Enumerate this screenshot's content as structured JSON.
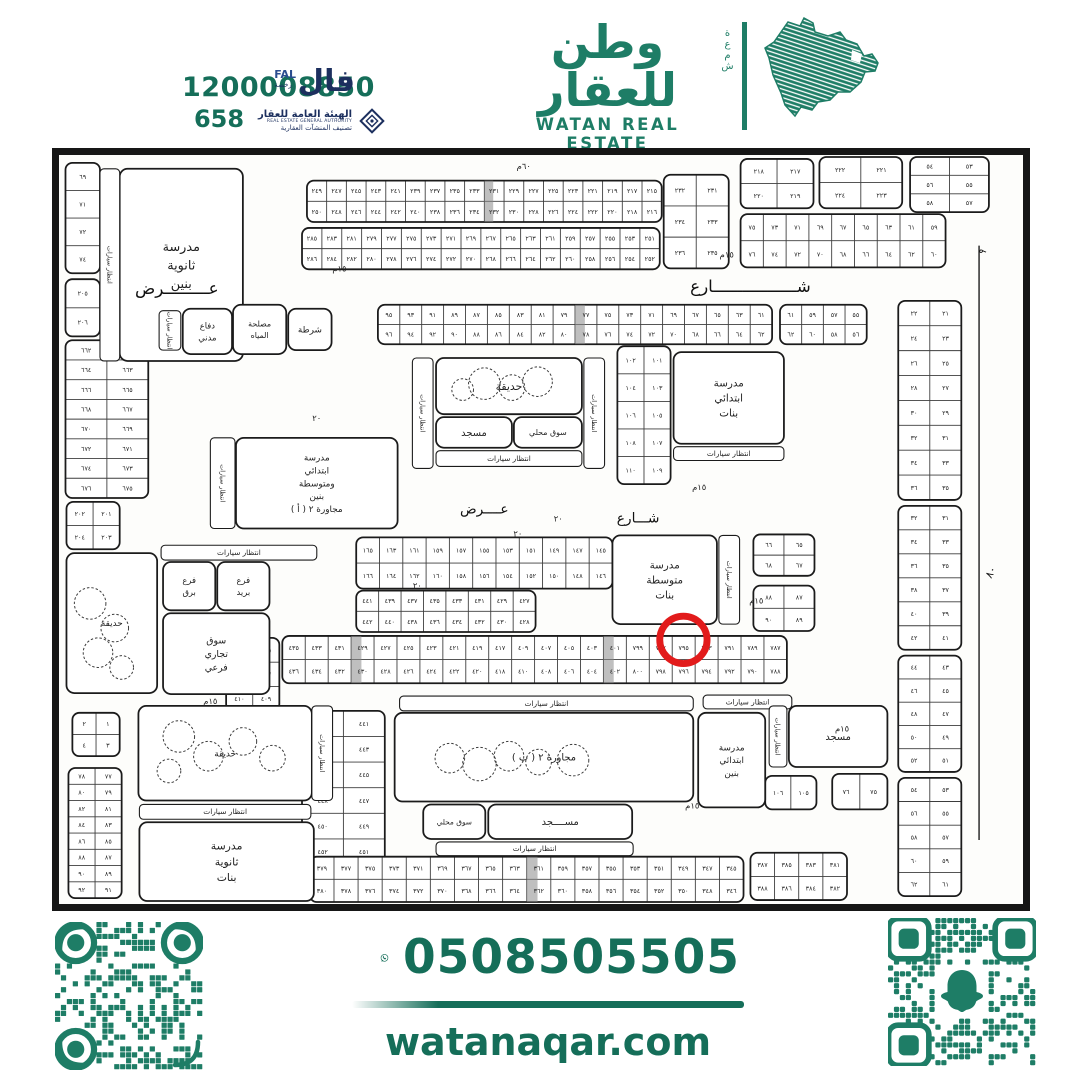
{
  "colors": {
    "brand": "#1E7D66",
    "deep": "#156E59",
    "navy": "#1C2F5E",
    "ink": "#1b1b1b",
    "red": "#E21B1B"
  },
  "header": {
    "phone1": "1200008850",
    "phone2": "658",
    "fal": {
      "ar": "فال",
      "latin": "FAL",
      "license": "رخصة"
    },
    "rega": {
      "l1": "الهيئة العامة للعقار",
      "l2": "REAL ESTATE GENERAL AUTHORITY",
      "l3": "تصنيف المنشآت العقارية"
    }
  },
  "brand": {
    "ar": "وطن للعقار",
    "en": "WATAN REAL ESTATE",
    "vertical": "شمعة"
  },
  "footer": {
    "phone": "0508505505",
    "site": "watanaqar.com"
  },
  "map": {
    "parking": "انتظار سيارات",
    "streets": [
      {
        "t": "عـــــــــرض",
        "x": 118,
        "y": 141,
        "fs": 17
      },
      {
        "t": "شـــــــــــــــــارع",
        "x": 700,
        "y": 139,
        "fs": 17
      },
      {
        "t": "عــــرض",
        "x": 430,
        "y": 364,
        "fs": 14
      },
      {
        "t": "شـــارع",
        "x": 586,
        "y": 373,
        "fs": 14
      },
      {
        "t": "٨٠",
        "x": 947,
        "y": 425,
        "fs": 11,
        "rot": -62
      },
      {
        "t": "٩",
        "x": 938,
        "y": 100,
        "fs": 10,
        "rot": -55
      }
    ],
    "wlabels": [
      {
        "t": "١٥م",
        "x": 283,
        "y": 118
      },
      {
        "t": "١٥م",
        "x": 676,
        "y": 104
      },
      {
        "t": "١٥م",
        "x": 648,
        "y": 340
      },
      {
        "t": "١٥م",
        "x": 706,
        "y": 455
      },
      {
        "t": "١٥م",
        "x": 641,
        "y": 663
      },
      {
        "t": "١٥م",
        "x": 152,
        "y": 557
      },
      {
        "t": "٢٠",
        "x": 260,
        "y": 270
      },
      {
        "t": "٢٠",
        "x": 362,
        "y": 440
      },
      {
        "t": "٢٠",
        "x": 464,
        "y": 387
      },
      {
        "t": "٢٠",
        "x": 505,
        "y": 372
      },
      {
        "t": "٦٠م",
        "x": 470,
        "y": 14
      },
      {
        "t": "١٥م",
        "x": 793,
        "y": 585
      }
    ],
    "landmarks": [
      {
        "id": "sec-boys-school",
        "x": 60,
        "y": 14,
        "w": 125,
        "h": 195,
        "fs": 13,
        "l": [
          "مدرسة",
          "ثانوية",
          "بنين"
        ]
      },
      {
        "id": "civil-defense",
        "x": 124,
        "y": 156,
        "w": 50,
        "h": 46,
        "fs": 8.5,
        "l": [
          "دفاع",
          "مدني"
        ]
      },
      {
        "id": "water-authority",
        "x": 175,
        "y": 152,
        "w": 54,
        "h": 50,
        "fs": 8,
        "l": [
          "مصلحة",
          "المياه"
        ]
      },
      {
        "id": "police",
        "x": 231,
        "y": 156,
        "w": 44,
        "h": 42,
        "fs": 9,
        "l": [
          "شرطة"
        ]
      },
      {
        "id": "garden-top",
        "x": 381,
        "y": 206,
        "w": 148,
        "h": 57,
        "fs": 11,
        "l": [
          "حديقة"
        ]
      },
      {
        "id": "mosque-top",
        "x": 381,
        "y": 266,
        "w": 77,
        "h": 31,
        "fs": 10,
        "l": [
          "مسجد"
        ]
      },
      {
        "id": "market-top",
        "x": 460,
        "y": 266,
        "w": 69,
        "h": 31,
        "fs": 8,
        "l": [
          "سوق محلي"
        ]
      },
      {
        "id": "girls-primary-school",
        "x": 622,
        "y": 200,
        "w": 112,
        "h": 93,
        "fs": 10.5,
        "l": [
          "مدرسة",
          "ابتدائي",
          "بنات"
        ]
      },
      {
        "id": "school-2a",
        "x": 178,
        "y": 287,
        "w": 164,
        "h": 92,
        "fs": 9,
        "l": [
          "مدرسة",
          "ابتدائي",
          "ومتوسطة",
          "بنين",
          "مجاورة ٢ ( أ )"
        ]
      },
      {
        "id": "telegraph-branch",
        "x": 104,
        "y": 413,
        "w": 53,
        "h": 49,
        "fs": 8.5,
        "l": [
          "فرع",
          "برق"
        ]
      },
      {
        "id": "post-branch",
        "x": 159,
        "y": 413,
        "w": 53,
        "h": 49,
        "fs": 8.5,
        "l": [
          "فرع",
          "بريد"
        ]
      },
      {
        "id": "sub-market",
        "x": 104,
        "y": 465,
        "w": 108,
        "h": 82,
        "fs": 9.5,
        "l": [
          "سوق",
          "تجاري",
          "فرعي"
        ]
      },
      {
        "id": "garden-left",
        "x": 6,
        "y": 404,
        "w": 92,
        "h": 142,
        "fs": 9,
        "l": [
          "حديقة"
        ]
      },
      {
        "id": "girls-middle-school",
        "x": 560,
        "y": 386,
        "w": 106,
        "h": 90,
        "fs": 10.5,
        "l": [
          "مدرسة",
          "متوسطة",
          "بنات"
        ]
      },
      {
        "id": "block-2b",
        "x": 339,
        "y": 566,
        "w": 303,
        "h": 90,
        "fs": 10,
        "l": [
          "مجاورة ٢ ( ب )"
        ]
      },
      {
        "id": "market-2b",
        "x": 368,
        "y": 659,
        "w": 63,
        "h": 35,
        "fs": 7.5,
        "l": [
          "سوق محلي"
        ]
      },
      {
        "id": "mosque-2b",
        "x": 434,
        "y": 659,
        "w": 146,
        "h": 35,
        "fs": 10,
        "l": [
          "مســــجد"
        ]
      },
      {
        "id": "boys-primary-school",
        "x": 647,
        "y": 566,
        "w": 68,
        "h": 96,
        "fs": 9,
        "l": [
          "مدرسة",
          "ابتدائي",
          "بنين"
        ]
      },
      {
        "id": "mosque-east",
        "x": 739,
        "y": 559,
        "w": 100,
        "h": 62,
        "fs": 10,
        "l": [
          "مسجد"
        ]
      },
      {
        "id": "garden-bottom",
        "x": 79,
        "y": 559,
        "w": 176,
        "h": 96,
        "fs": 9,
        "l": [
          "حديقة"
        ]
      },
      {
        "id": "girls-sec-school",
        "x": 80,
        "y": 677,
        "w": 177,
        "h": 80,
        "fs": 11,
        "l": [
          "مدرسة",
          "ثانوية",
          "بنات"
        ]
      }
    ],
    "plabels": [
      {
        "x": 40,
        "y": 14,
        "w": 20,
        "h": 195,
        "v": 1
      },
      {
        "x": 100,
        "y": 158,
        "w": 22,
        "h": 40,
        "v": 1
      },
      {
        "x": 357,
        "y": 206,
        "w": 21,
        "h": 112,
        "v": 1
      },
      {
        "x": 531,
        "y": 206,
        "w": 21,
        "h": 112,
        "v": 1
      },
      {
        "x": 381,
        "y": 300,
        "w": 148,
        "h": 16
      },
      {
        "x": 622,
        "y": 296,
        "w": 112,
        "h": 14
      },
      {
        "x": 152,
        "y": 287,
        "w": 25,
        "h": 92,
        "v": 1
      },
      {
        "x": 102,
        "y": 396,
        "w": 158,
        "h": 15
      },
      {
        "x": 668,
        "y": 386,
        "w": 21,
        "h": 90,
        "v": 1
      },
      {
        "x": 344,
        "y": 549,
        "w": 298,
        "h": 15
      },
      {
        "x": 381,
        "y": 697,
        "w": 200,
        "h": 14
      },
      {
        "x": 652,
        "y": 548,
        "w": 90,
        "h": 14
      },
      {
        "x": 719,
        "y": 559,
        "w": 18,
        "h": 62,
        "v": 1
      },
      {
        "x": 255,
        "y": 559,
        "w": 21,
        "h": 96,
        "v": 1
      },
      {
        "x": 80,
        "y": 659,
        "w": 174,
        "h": 15
      }
    ],
    "trees": [
      {
        "x": 430,
        "y": 232,
        "r": 16
      },
      {
        "x": 458,
        "y": 236,
        "r": 13
      },
      {
        "x": 484,
        "y": 230,
        "r": 15
      },
      {
        "x": 408,
        "y": 238,
        "r": 11
      },
      {
        "x": 30,
        "y": 455,
        "r": 16
      },
      {
        "x": 55,
        "y": 480,
        "r": 14
      },
      {
        "x": 38,
        "y": 505,
        "r": 15
      },
      {
        "x": 62,
        "y": 520,
        "r": 12
      },
      {
        "x": 395,
        "y": 612,
        "r": 15
      },
      {
        "x": 425,
        "y": 618,
        "r": 17
      },
      {
        "x": 455,
        "y": 610,
        "r": 15
      },
      {
        "x": 485,
        "y": 616,
        "r": 13
      },
      {
        "x": 520,
        "y": 614,
        "r": 16
      },
      {
        "x": 120,
        "y": 590,
        "r": 16
      },
      {
        "x": 150,
        "y": 610,
        "r": 15
      },
      {
        "x": 185,
        "y": 595,
        "r": 14
      },
      {
        "x": 215,
        "y": 612,
        "r": 13
      },
      {
        "x": 110,
        "y": 625,
        "r": 12
      }
    ],
    "blocks": [
      {
        "x": 5,
        "y": 8,
        "w": 35,
        "h": 112,
        "c": 1,
        "r": 4,
        "n": [
          "٦٩",
          "٧١",
          "٧٢",
          "٧٤"
        ]
      },
      {
        "x": 5,
        "y": 126,
        "w": 35,
        "h": 58,
        "c": 1,
        "r": 2,
        "n": [
          "٢٠٥",
          "٢٠٦"
        ]
      },
      {
        "x": 250,
        "y": 26,
        "w": 360,
        "h": 42,
        "c": 18,
        "r": 2,
        "g": "h249",
        "ht": [
          9
        ]
      },
      {
        "x": 245,
        "y": 74,
        "w": 363,
        "h": 42,
        "c": 18,
        "r": 2,
        "g": "h285"
      },
      {
        "x": 612,
        "y": 20,
        "w": 66,
        "h": 95,
        "c": 2,
        "r": 3,
        "g": "v231"
      },
      {
        "x": 690,
        "y": 4,
        "w": 74,
        "h": 50,
        "c": 2,
        "r": 2,
        "g": "v217"
      },
      {
        "x": 770,
        "y": 2,
        "w": 84,
        "h": 52,
        "c": 2,
        "r": 2,
        "g": "v221"
      },
      {
        "x": 862,
        "y": 2,
        "w": 80,
        "h": 56,
        "c": 2,
        "r": 3,
        "g": "v53"
      },
      {
        "x": 690,
        "y": 60,
        "w": 208,
        "h": 54,
        "c": 9,
        "r": 2,
        "g": "h75"
      },
      {
        "x": 322,
        "y": 152,
        "w": 400,
        "h": 40,
        "c": 18,
        "r": 2,
        "g": "h95",
        "ht": [
          9
        ]
      },
      {
        "x": 730,
        "y": 152,
        "w": 88,
        "h": 40,
        "c": 4,
        "r": 2,
        "g": "h61"
      },
      {
        "x": 5,
        "y": 188,
        "w": 84,
        "h": 160,
        "c": 2,
        "r": 8,
        "g": "v661"
      },
      {
        "x": 6,
        "y": 352,
        "w": 54,
        "h": 48,
        "c": 2,
        "r": 2,
        "g": "v201"
      },
      {
        "x": 300,
        "y": 388,
        "w": 260,
        "h": 52,
        "c": 11,
        "r": 2,
        "g": "h165"
      },
      {
        "x": 300,
        "y": 442,
        "w": 182,
        "h": 42,
        "c": 8,
        "r": 2,
        "g": "h441"
      },
      {
        "x": 565,
        "y": 194,
        "w": 54,
        "h": 140,
        "c": 2,
        "r": 5,
        "g": "v101"
      },
      {
        "x": 703,
        "y": 385,
        "w": 62,
        "h": 42,
        "c": 2,
        "r": 2,
        "g": "v65"
      },
      {
        "x": 703,
        "y": 437,
        "w": 62,
        "h": 46,
        "c": 2,
        "r": 2,
        "g": "v87"
      },
      {
        "x": 850,
        "y": 148,
        "w": 64,
        "h": 202,
        "c": 2,
        "r": 8,
        "g": "v21"
      },
      {
        "x": 850,
        "y": 356,
        "w": 64,
        "h": 146,
        "c": 2,
        "r": 6,
        "g": "v31"
      },
      {
        "x": 850,
        "y": 508,
        "w": 64,
        "h": 118,
        "c": 2,
        "r": 5,
        "g": "v43"
      },
      {
        "x": 850,
        "y": 632,
        "w": 64,
        "h": 120,
        "c": 2,
        "r": 5,
        "g": "v53"
      },
      {
        "x": 225,
        "y": 488,
        "w": 512,
        "h": 48,
        "c": 22,
        "r": 2,
        "ht": [
          3,
          14
        ],
        "n": [
          "٤٣٥",
          "٤٣٣",
          "٤٣١",
          "٤٢٩",
          "٤٢٧",
          "٤٢٥",
          "٤٢٣",
          "٤٢١",
          "٤١٩",
          "٤١٧",
          "٤٠٩",
          "٤٠٧",
          "٤٠٥",
          "٤٠٣",
          "٤٠١",
          "٧٩٩",
          "٧٩٧",
          "٧٩٥",
          "٧٩٣",
          "٧٩١",
          "٧٨٩",
          "٧٨٧",
          "٤٣٦",
          "٤٣٤",
          "٤٣٢",
          "٤٣٠",
          "٤٢٨",
          "٤٢٦",
          "٤٢٤",
          "٤٢٢",
          "٤٢٠",
          "٤١٨",
          "٤١٠",
          "٤٠٨",
          "٤٠٦",
          "٤٠٤",
          "٤٠٢",
          "٨٠٠",
          "٧٩٨",
          "٧٩٦",
          "٧٩٤",
          "٧٩٢",
          "٧٩٠",
          "٧٨٨"
        ]
      },
      {
        "x": 168,
        "y": 490,
        "w": 54,
        "h": 74,
        "c": 2,
        "r": 3,
        "g": "v405"
      },
      {
        "x": 245,
        "y": 564,
        "w": 84,
        "h": 182,
        "c": 2,
        "r": 7,
        "g": "v441"
      },
      {
        "x": 253,
        "y": 712,
        "w": 440,
        "h": 46,
        "c": 18,
        "r": 2,
        "g": "h379",
        "ht": [
          9
        ]
      },
      {
        "x": 700,
        "y": 708,
        "w": 98,
        "h": 48,
        "c": 4,
        "r": 2,
        "g": "h387"
      },
      {
        "x": 715,
        "y": 630,
        "w": 52,
        "h": 34,
        "c": 2,
        "r": 1,
        "n": [
          "١٠٦",
          "١٠٥"
        ]
      },
      {
        "x": 783,
        "y": 628,
        "w": 56,
        "h": 36,
        "c": 2,
        "r": 1,
        "n": [
          "٧٦",
          "٧٥"
        ]
      },
      {
        "x": 8,
        "y": 622,
        "w": 54,
        "h": 132,
        "c": 2,
        "r": 8,
        "g": "v77"
      },
      {
        "x": 12,
        "y": 566,
        "w": 48,
        "h": 44,
        "c": 2,
        "r": 2,
        "g": "v1"
      }
    ],
    "marker": {
      "x": 632,
      "y": 492,
      "r": 24,
      "plot": "٧٩٥"
    }
  }
}
